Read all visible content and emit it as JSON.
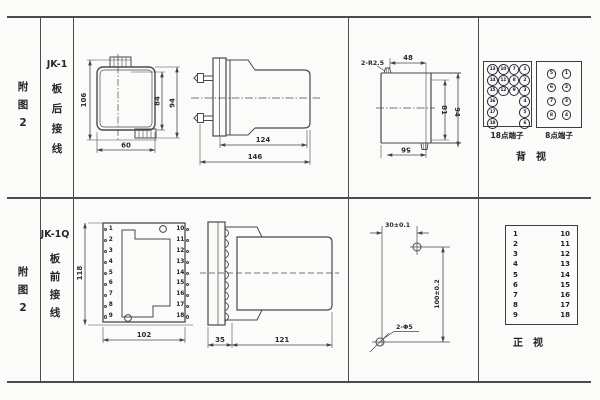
{
  "row1": {
    "fig_chars": [
      "附",
      "图",
      "2"
    ],
    "model_name": "JK-1",
    "model_chars": [
      "板",
      "后",
      "接",
      "线"
    ],
    "rear_mount_view": {
      "dim_height": "106",
      "dim_width": "60",
      "dim_inner_height": "84",
      "dim_outer_height": "94"
    },
    "side_view": {
      "dim_body_depth": "124",
      "dim_total_depth": "146"
    },
    "panel_cut_view": {
      "radius_label": "2-R2.5",
      "dim_top_width": "48",
      "dim_inner_height": "81",
      "dim_outer_height": "94",
      "dim_bottom_width": "56"
    },
    "terminal18": {
      "caption": "18点端子",
      "rows": [
        [
          "13",
          "10",
          "7",
          "1"
        ],
        [
          "14",
          "11",
          "8",
          "2"
        ],
        [
          "15",
          "12",
          "9",
          "3"
        ],
        [
          "16",
          "",
          "",
          "4"
        ],
        [
          "17",
          "",
          "",
          "5"
        ],
        [
          "18",
          "",
          "",
          "6"
        ]
      ]
    },
    "terminal8": {
      "caption": "8点端子",
      "rows": [
        [
          "5",
          "1"
        ],
        [
          "6",
          "2"
        ],
        [
          "7",
          "3"
        ],
        [
          "8",
          "4"
        ]
      ]
    },
    "view_caption": "背　视"
  },
  "row2": {
    "fig_chars": [
      "附",
      "图",
      "2"
    ],
    "model_name": "JK-1Q",
    "model_chars": [
      "板",
      "前",
      "接",
      "线"
    ],
    "front_view": {
      "dim_height": "118",
      "dim_width": "102",
      "left_terminals": [
        "1",
        "2",
        "3",
        "4",
        "5",
        "6",
        "7",
        "8",
        "9"
      ],
      "right_terminals": [
        "10",
        "11",
        "12",
        "13",
        "14",
        "15",
        "16",
        "17",
        "18"
      ]
    },
    "side_view": {
      "dim_front_depth": "35",
      "dim_body_depth": "121"
    },
    "drill_view": {
      "dim_h_spacing": "30±0.1",
      "dim_v_spacing": "100±0.2",
      "hole_label": "2-Φ5"
    },
    "terminal_table": {
      "left": [
        "1",
        "2",
        "3",
        "4",
        "5",
        "6",
        "7",
        "8",
        "9"
      ],
      "right": [
        "10",
        "11",
        "12",
        "13",
        "14",
        "15",
        "16",
        "17",
        "18"
      ]
    },
    "view_caption": "正　视"
  },
  "colors": {
    "line": "#4c4c4c",
    "text": "#262626",
    "background": "#fbfbfa"
  }
}
